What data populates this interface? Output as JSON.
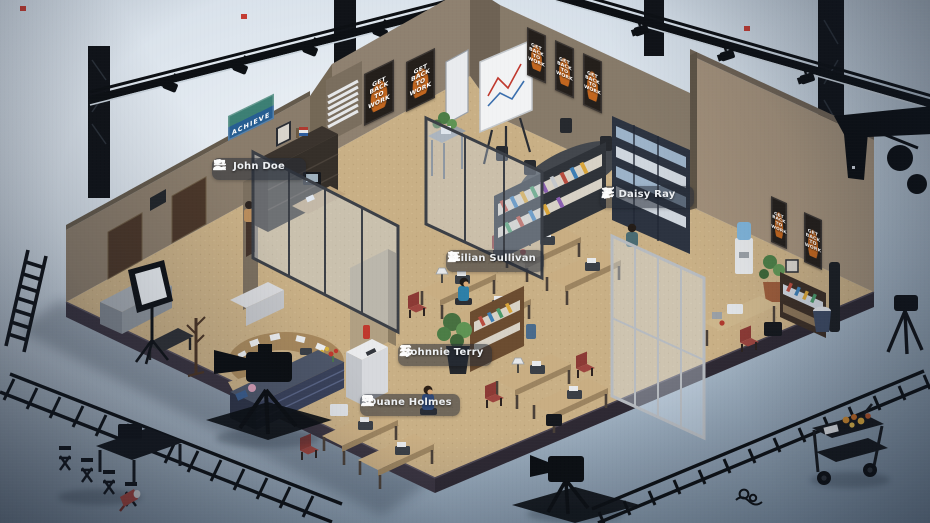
{
  "scene": {
    "description": "Isometric office interior on a film sound stage, surrounded by studio equipment",
    "characters": [
      {
        "name": "John Doe",
        "icons": [
          "menu-icon",
          "people-icon",
          "person-badge-icon"
        ]
      },
      {
        "name": "Daisy Ray",
        "icons": [
          "menu-icon",
          "megaphone-icon",
          "person-badge-icon"
        ]
      },
      {
        "name": "Lilian Sullivan",
        "icons": [
          "menu-icon",
          "pie-chart-icon",
          "person-badge-icon"
        ]
      },
      {
        "name": "Johnnie Terry",
        "icons": [
          "menu-icon",
          "director-chair-icon",
          "person-badge-icon"
        ]
      },
      {
        "name": "Duane Holmes",
        "icons": [
          "menu-icon",
          "director-chair-icon",
          "people-icon"
        ]
      }
    ],
    "posters": {
      "get_back": "GET\nBACK\nTO\nWORK",
      "achieve": "ACHIEVE"
    },
    "colors": {
      "floor_carpet": "#c9b086",
      "wall_taupe": "#8a7c6b",
      "wall_light": "#a2907a",
      "studio_floor_cool": "#8ba0b2",
      "equipment_silhouette": "#0e1116",
      "nameplate_bg": "rgba(38,44,54,0.55)",
      "poster_bg": "#241f1b",
      "poster_accent_orange": "#c2661f",
      "achieve_blue": "#275e92",
      "chair_red": "#8c3a35",
      "cabinet_navy": "#3c4254",
      "truss_light_red": "#c43c33",
      "glass_tint": "rgba(210,225,240,0.38)"
    }
  }
}
